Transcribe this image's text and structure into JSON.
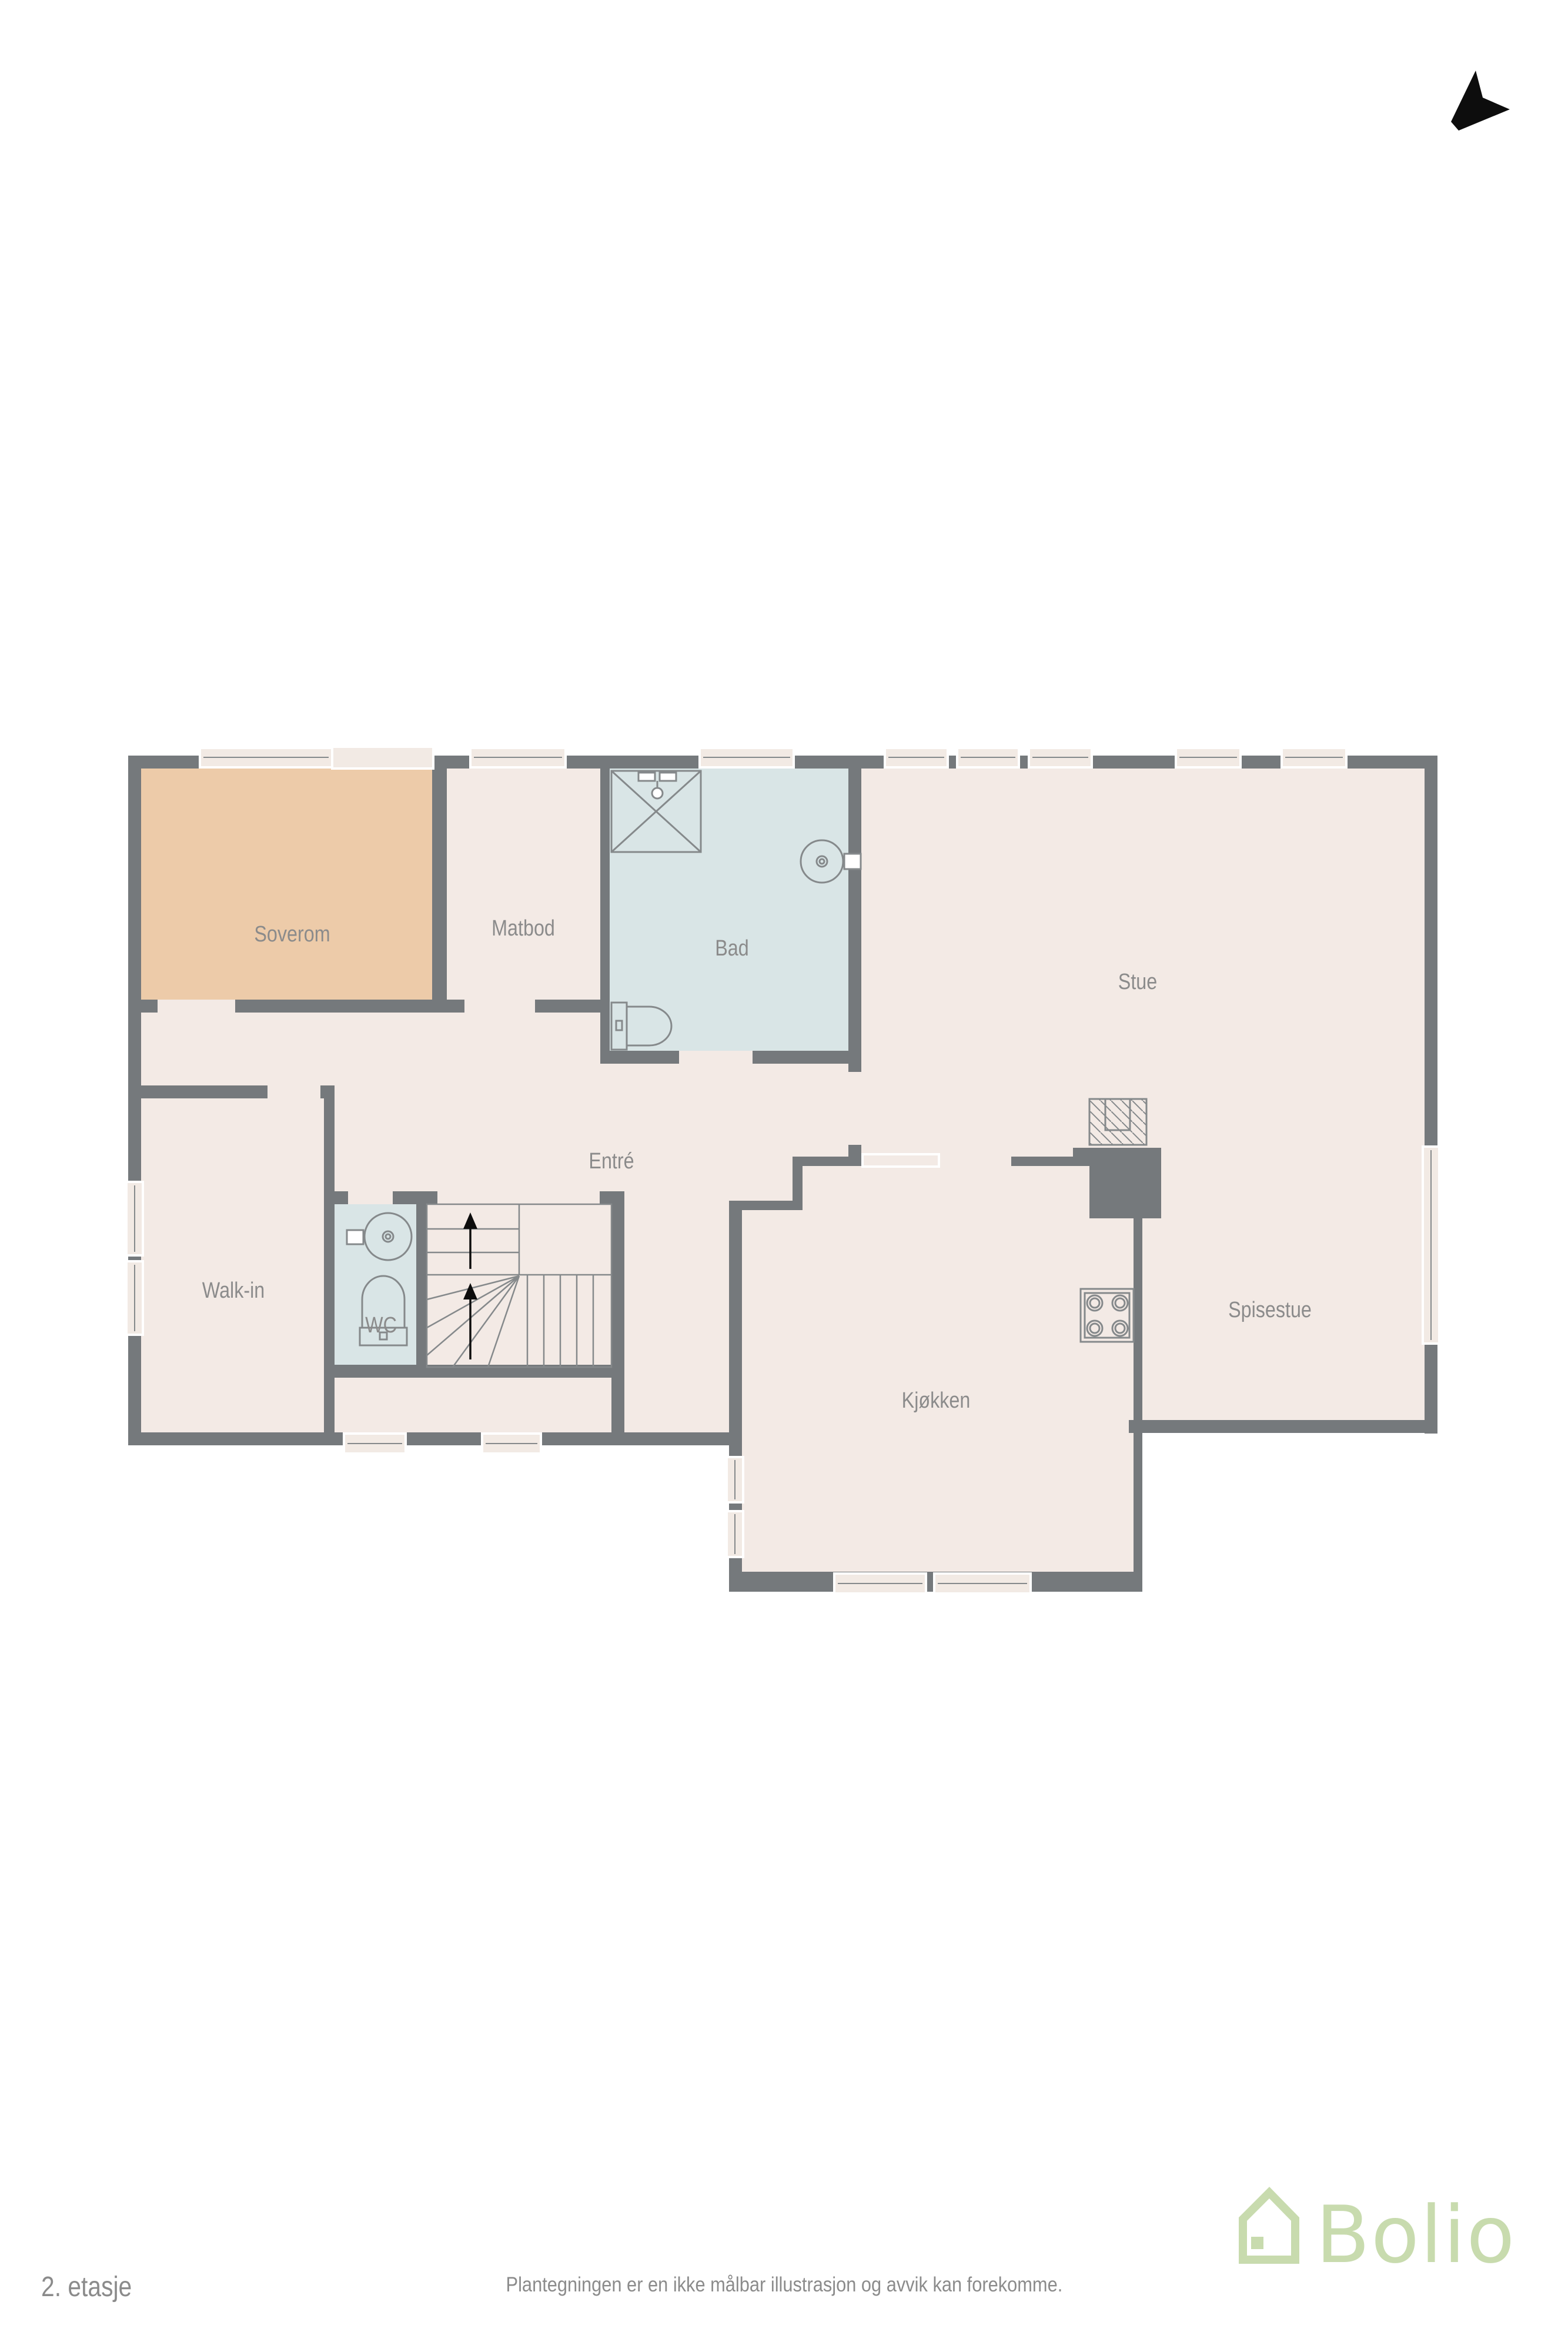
{
  "floor_plan": {
    "floor_label": "2. etasje",
    "disclaimer": "Plantegningen er en ikke målbar illustrasjon og avvik kan forekomme.",
    "rooms": {
      "soverom": "Soverom",
      "matbod": "Matbod",
      "bad": "Bad",
      "stue": "Stue",
      "walk_in": "Walk-in",
      "wc": "WC",
      "entre": "Entré",
      "kjokken": "Kjøkken",
      "spisestue": "Spisestue"
    },
    "brand": {
      "name": "Bolio"
    },
    "icons": {
      "north": "north-arrow-icon",
      "house": "bolio-house-icon",
      "fireplace": "fireplace-hatch-icon",
      "stove": "stove-4-burner-icon",
      "shower": "shower-icon",
      "toilet": "toilet-icon",
      "basin": "round-basin-icon",
      "stairs": "staircase-icon"
    },
    "colors": {
      "wall": "#75797c",
      "room": "#f3eae5",
      "bedroom": "#edcba9",
      "wet": "#d9e5e6",
      "winfill": "#f2eae4",
      "fixture": "#85898b",
      "label": "#8b8b8b",
      "brand": "#c8dbae"
    }
  }
}
